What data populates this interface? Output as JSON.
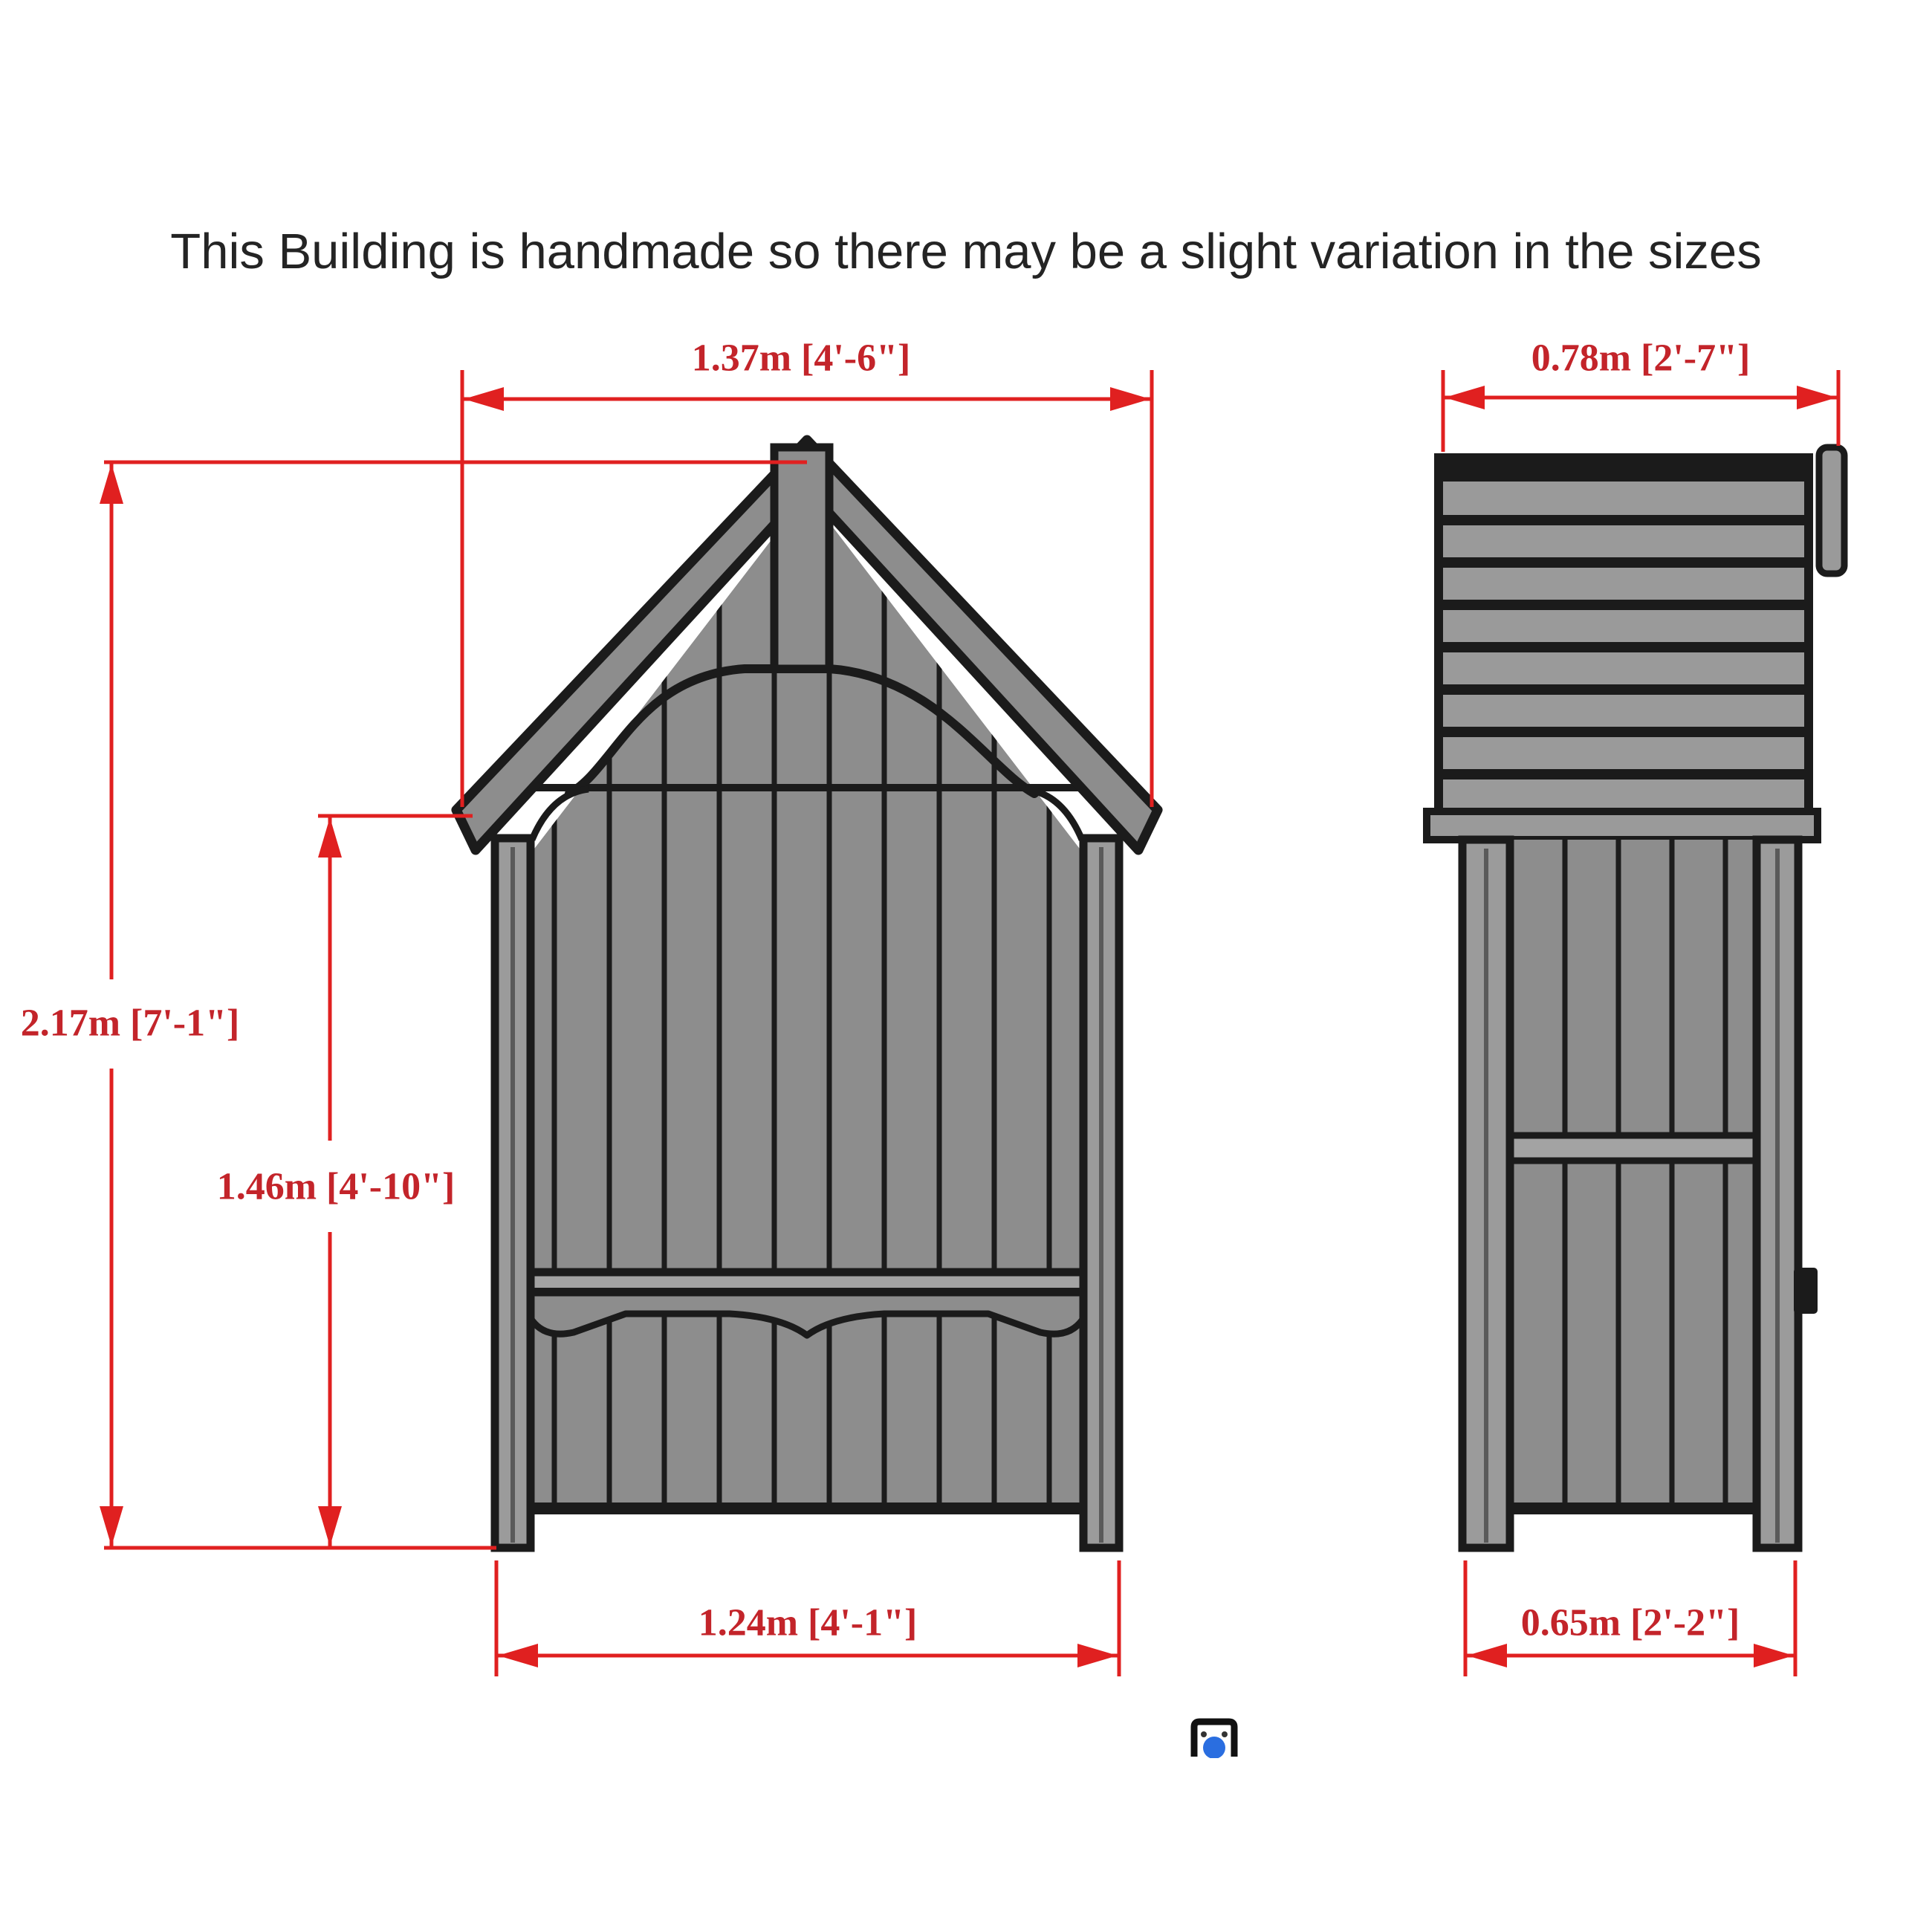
{
  "header": {
    "title": "This Building is handmade so there may be a slight variation in the sizes"
  },
  "drawing": {
    "type": "technical-elevation-diagram",
    "subject": "garden arbour / seat building, front and side elevations",
    "colors": {
      "dimension_line_red": "#e02020",
      "dimension_text_red": "#c3242a",
      "wood_gray": "#8d8d8d",
      "board_light_gray": "#9b9b9b",
      "outline_black": "#1b1b1b",
      "icon_blue": "#2a6ee0"
    }
  },
  "dimensions": {
    "front_width": "1.37m [4'-6\"]",
    "side_depth": "0.78m [2'-7\"]",
    "overall_height": "2.17m [7'-1\"]",
    "eaves_height": "1.46m [4'-10\"]",
    "front_base_width": "1.24m [4'-1\"]",
    "side_base_depth": "0.65m [2'-2\"]"
  }
}
